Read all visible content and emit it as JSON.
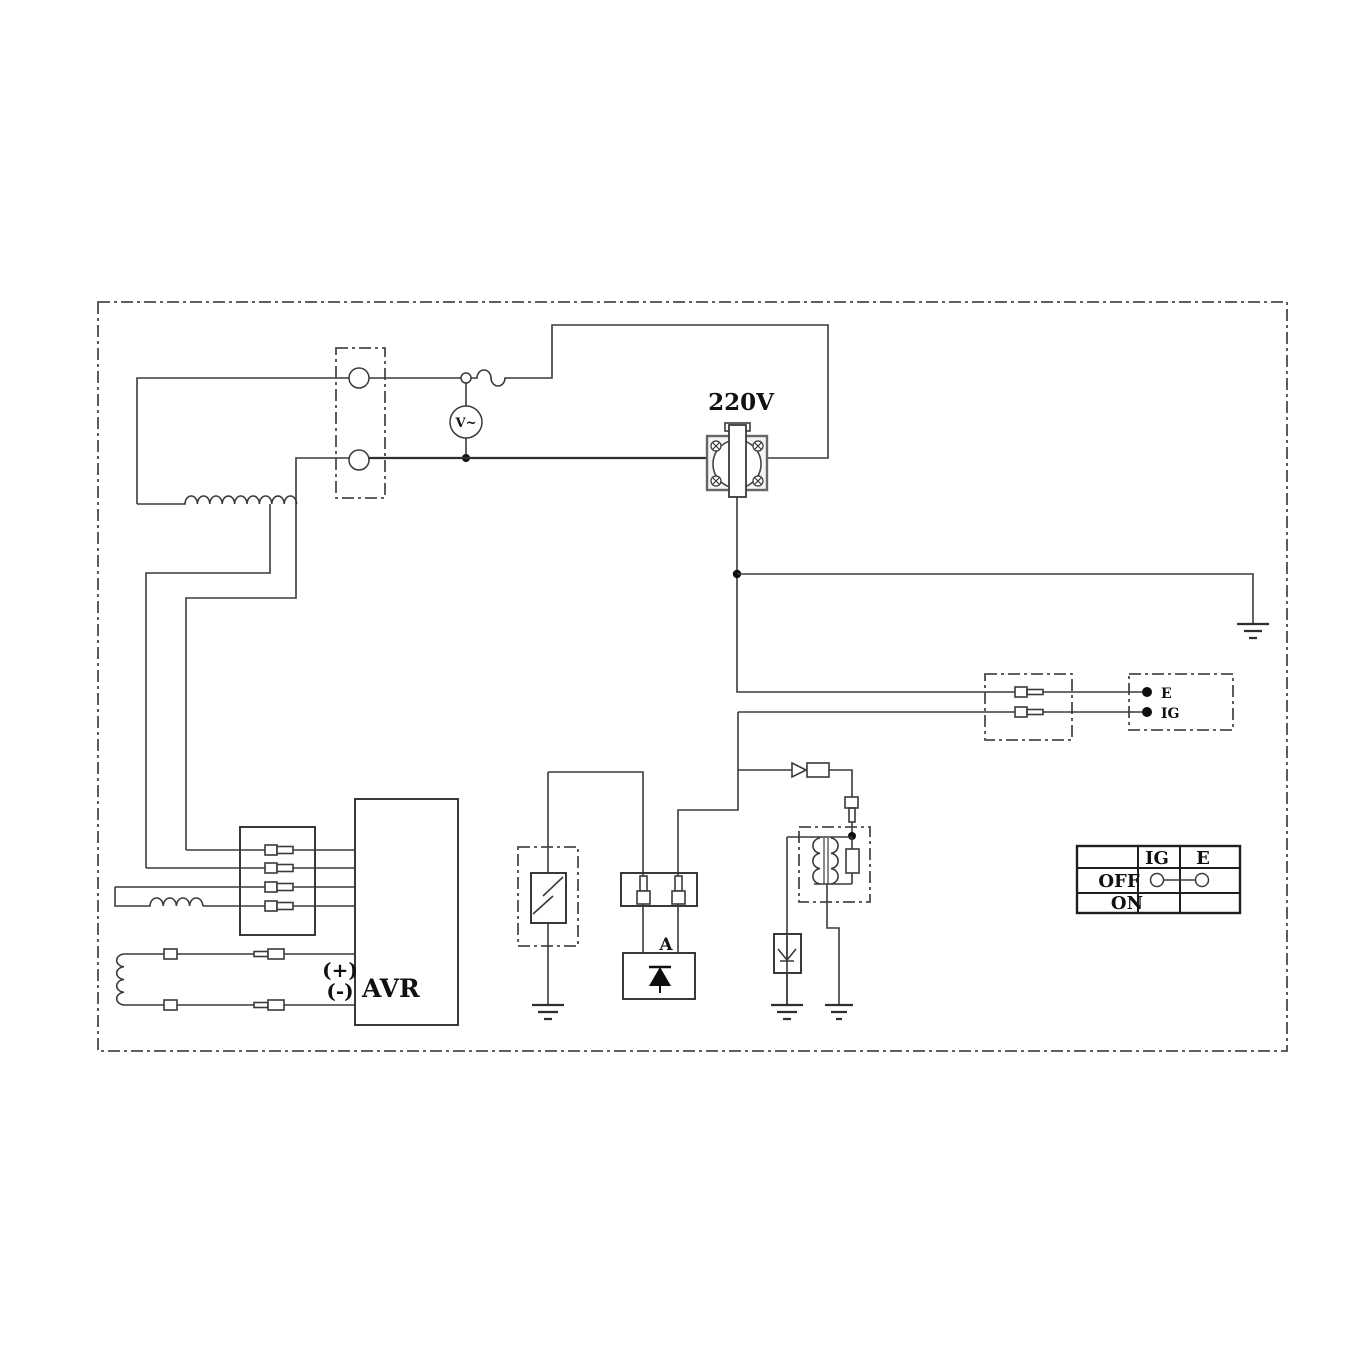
{
  "labels": {
    "socket_voltage": "220V",
    "voltmeter": "V~",
    "avr": "AVR",
    "avr_plus": "(+)",
    "avr_minus": "(-)",
    "rectifier_a": "A",
    "terminal_e": "E",
    "terminal_ig": "IG"
  },
  "switch_table": {
    "columns": [
      "IG",
      "E"
    ],
    "rows": [
      {
        "label": "OFF",
        "ig_e_connected": true
      },
      {
        "label": "ON",
        "ig_e_connected": false
      }
    ]
  },
  "colors": {
    "line": "#3a3a3a",
    "text": "#111111",
    "background": "#ffffff"
  }
}
